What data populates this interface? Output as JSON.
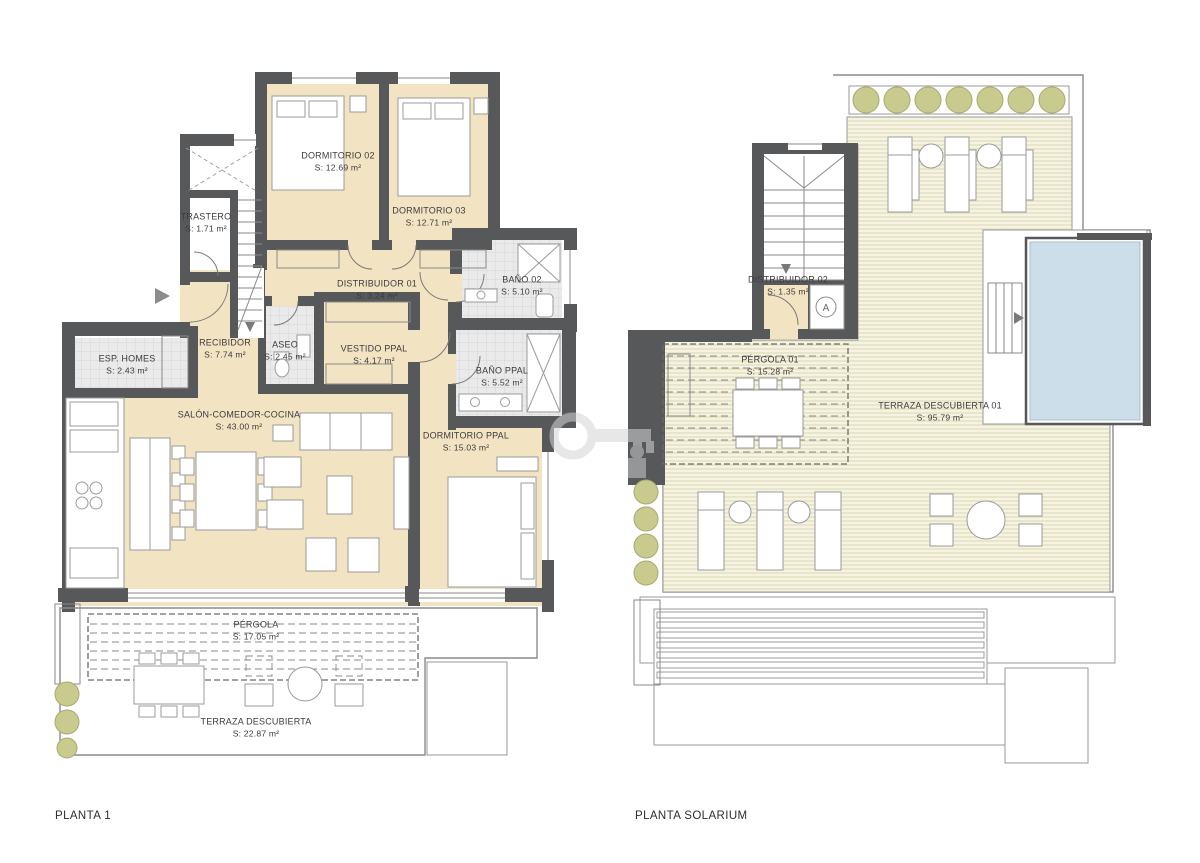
{
  "plan1": {
    "title": "PLANTA 1",
    "rooms": [
      {
        "name": "DORMITORIO 02",
        "area": "S: 12.69 m²"
      },
      {
        "name": "DORMITORIO 03",
        "area": "S: 12.71 m²"
      },
      {
        "name": "TRASTERO",
        "area": "S: 1.71 m²"
      },
      {
        "name": "DISTRIBUIDOR 01",
        "area": "S: 3.24 m²"
      },
      {
        "name": "BAÑO 02",
        "area": "S: 5.10 m²"
      },
      {
        "name": "ESP. HOMES",
        "area": "S: 2.43 m²"
      },
      {
        "name": "RECIBIDOR",
        "area": "S: 7.74 m²"
      },
      {
        "name": "ASEO",
        "area": "S: 2.45 m²"
      },
      {
        "name": "VESTIDO PPAL",
        "area": "S: 4.17 m²"
      },
      {
        "name": "BAÑO PPAL",
        "area": "S: 5.52 m²"
      },
      {
        "name": "SALÓN-COMEDOR-COCINA",
        "area": "S: 43.00 m²"
      },
      {
        "name": "DORMITORIO PPAL",
        "area": "S: 15.03 m²"
      },
      {
        "name": "PÉRGOLA",
        "area": "S: 17.05 m²"
      },
      {
        "name": "TERRAZA DESCUBIERTA",
        "area": "S: 22.87 m²"
      }
    ]
  },
  "plan2": {
    "title": "PLANTA SOLARIUM",
    "elevator_label": "A",
    "rooms": [
      {
        "name": "DISTRIBUIDOR 02",
        "area": "S: 1.35 m²"
      },
      {
        "name": "PÉRGOLA 01",
        "area": "S: 15.28 m²"
      },
      {
        "name": "TERRAZA DESCUBIERTA 01",
        "area": "S: 95.79 m²"
      }
    ]
  },
  "colors": {
    "wall": "#57585a",
    "floor_beige": "#f2e3c2",
    "tile": "#eaeaea",
    "deck": "#f6f3e2",
    "deck_line": "#dbd8b2",
    "plant": "#c9ca8e",
    "pool": "#cbdeea",
    "outline": "#8a8a8a",
    "label_text": "#3c3c3c"
  }
}
